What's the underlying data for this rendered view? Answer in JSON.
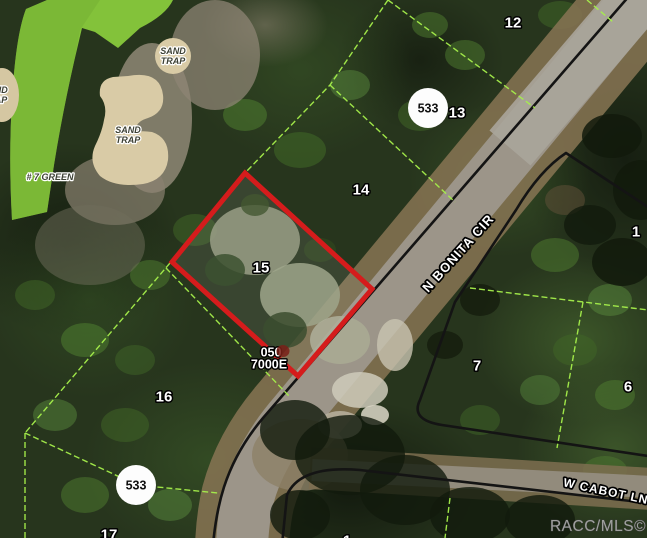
{
  "map": {
    "watermark": "RACC/MLS©",
    "roads": {
      "bonita": "N BONITA CIR",
      "cabot": "W CABOT LN"
    },
    "route_markers": [
      {
        "label": "533"
      },
      {
        "label": "533"
      }
    ],
    "highlighted_parcel": {
      "number": "15",
      "code_line1": "050",
      "code_line2": "7000E",
      "outline_color": "#d51c1c"
    },
    "parcels": [
      {
        "number": "12"
      },
      {
        "number": "13"
      },
      {
        "number": "14"
      },
      {
        "number": "16"
      },
      {
        "number": "17"
      },
      {
        "number": "1"
      },
      {
        "number": "7"
      },
      {
        "number": "6"
      },
      {
        "number": "1"
      }
    ],
    "golf": {
      "sand_trap_word1": "SAND",
      "sand_trap_word2": "TRAP",
      "green_label": "# 7 GREEN"
    },
    "colors": {
      "parcel_line": "#a5ef4b",
      "right_of_way_line": "#141414",
      "highlight_red": "#d51c1c",
      "golf_green": "#83c23a",
      "sand": "#d9cba6",
      "road_surface": "#9c9589"
    }
  }
}
